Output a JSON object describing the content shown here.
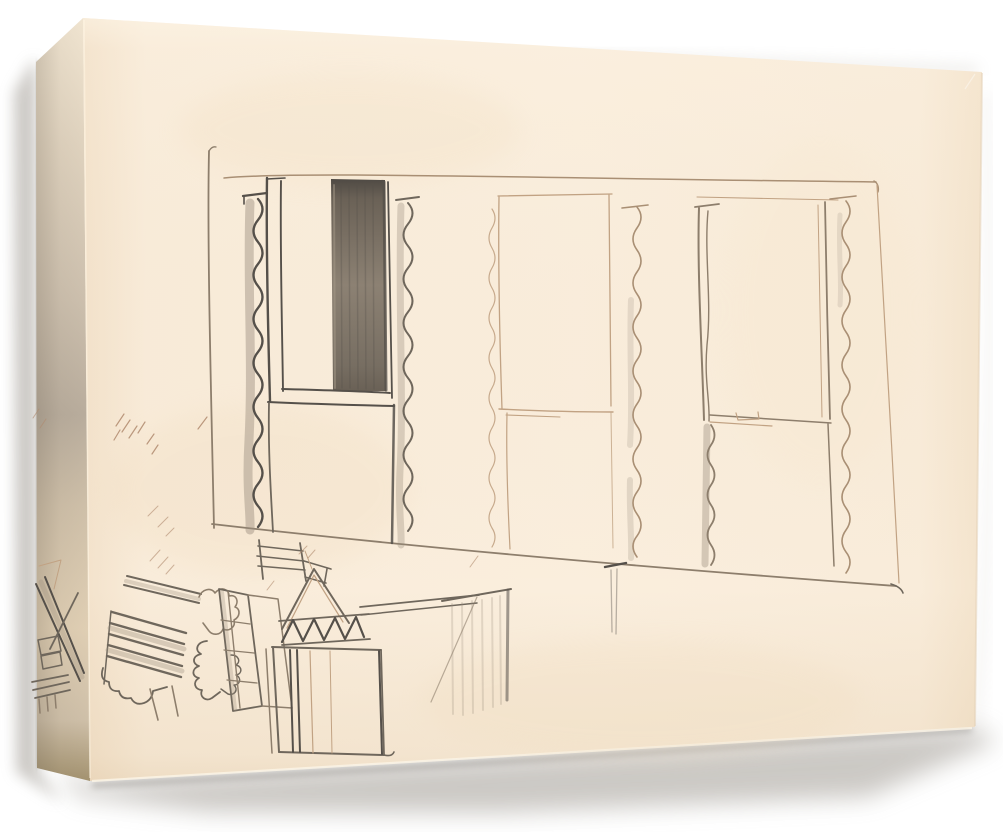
{
  "artwork": {
    "visible_text": "",
    "subject": "pencil sketch of a paneled wall with wavy curtained windows above a cluster of cubist still-life shapes, printed on a gallery-wrapped canvas shown in three-quarter view with soft drop shadow"
  },
  "colors": {
    "pageBg": "#ffffff",
    "frontEdgeLeft": "#f3e2cb",
    "frontBase": "#f9ecda",
    "frontBright": "#faeedd",
    "frontRight": "#f4e4cd",
    "frontHighlight": "#fdf5e6",
    "frontBottomShade": "#c8a878",
    "sideTop": "#f2e6d2",
    "sideUpper": "#e0d3bf",
    "sideMid": "#cdc0ae",
    "sideDark": "#b9ad9d",
    "sideLower": "#cfc0a9",
    "sideLight2": "#e0cfb4",
    "sideBottom": "#a3926f",
    "creaseHighlight": "#fff6e3",
    "shadowSoft": "#a29d95",
    "shadowCore": "#76716a",
    "pencilFaint": "#c1a283",
    "pencilLight": "#a98f74",
    "pencilMed": "#8d7e6c",
    "pencilMedDark": "#6f675c",
    "pencilDark": "#55504a",
    "shadeGray": "#9b8e7e",
    "colTop": "#4f4a44",
    "colDark": "#6a6156",
    "colMid": "#8c8173",
    "colLow": "#776e62",
    "bandTop": "#7b7163",
    "bandMid": "#a5988a",
    "barDark": "#514c46",
    "barLow": "#7a7165",
    "ghost": "#c9b89d",
    "speckOrange": "#c87137",
    "speckBrown": "#9b7653",
    "speckDark": "#6b5d4c",
    "speckRed": "#b5473a"
  }
}
